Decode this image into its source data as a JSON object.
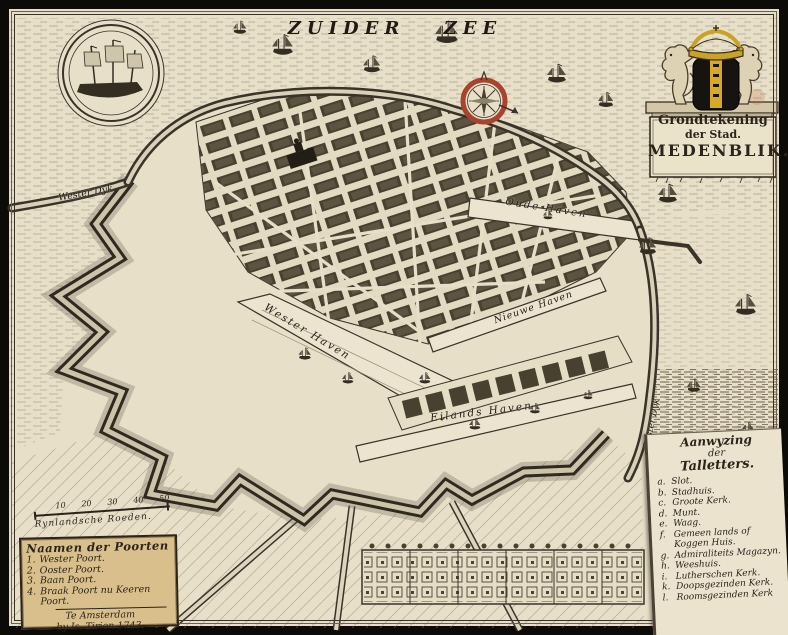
{
  "sea_title": "ZUIDER ZEE",
  "cartouche": {
    "title_line1": "Grondtekening",
    "title_line2": "der Stad.",
    "title_line3": "MEDENBLIK."
  },
  "map_labels": {
    "wester_dyk": "Wester Dyk",
    "ooster_dyk": "Ooster Dyk",
    "oude_haven": "Oude Haven",
    "nieuwe_haven": "Nieuwe Haven",
    "wester_haven": "Wester Haven",
    "eilands_haven": "Eilands Haven"
  },
  "scale_bar": {
    "ticks": [
      "10",
      "20",
      "30",
      "40",
      "50"
    ],
    "label": "Rynlandsche Roeden."
  },
  "legend_gates": {
    "title": "Naamen der Poorten",
    "items": [
      {
        "num": "1.",
        "label": "Wester Poort."
      },
      {
        "num": "2.",
        "label": "Ooster Poort."
      },
      {
        "num": "3.",
        "label": "Baan Poort."
      },
      {
        "num": "4.",
        "label": "Braak Poort nu Keeren Poort."
      }
    ],
    "imprint_line1": "Te Amsterdam",
    "imprint_line2": "by Is. Tirion 1743."
  },
  "legend_letters": {
    "title_line1": "Aanwyzing",
    "title_line2": "der",
    "title_line3": "Talletters.",
    "items": [
      {
        "key": "a.",
        "label": "Slot."
      },
      {
        "key": "b.",
        "label": "Stadhuis."
      },
      {
        "key": "c.",
        "label": "Groote Kerk."
      },
      {
        "key": "d.",
        "label": "Munt."
      },
      {
        "key": "e.",
        "label": "Waag."
      },
      {
        "key": "f.",
        "label": "Gemeen lands of Koggen Huis."
      },
      {
        "key": "g.",
        "label": "Admiraliteits Magazyn."
      },
      {
        "key": "h.",
        "label": "Weeshuis."
      },
      {
        "key": "i.",
        "label": "Lutherschen Kerk."
      },
      {
        "key": "k.",
        "label": "Doopsgezinden Kerk."
      },
      {
        "key": "l.",
        "label": "Roomsgezinden Kerk"
      }
    ]
  },
  "colors": {
    "paper": "#e8dfc8",
    "ink": "#2b241b",
    "compass_ring": "#a8442e",
    "crown_gold": "#c9a227",
    "gates_box": "#d9bf8b"
  }
}
